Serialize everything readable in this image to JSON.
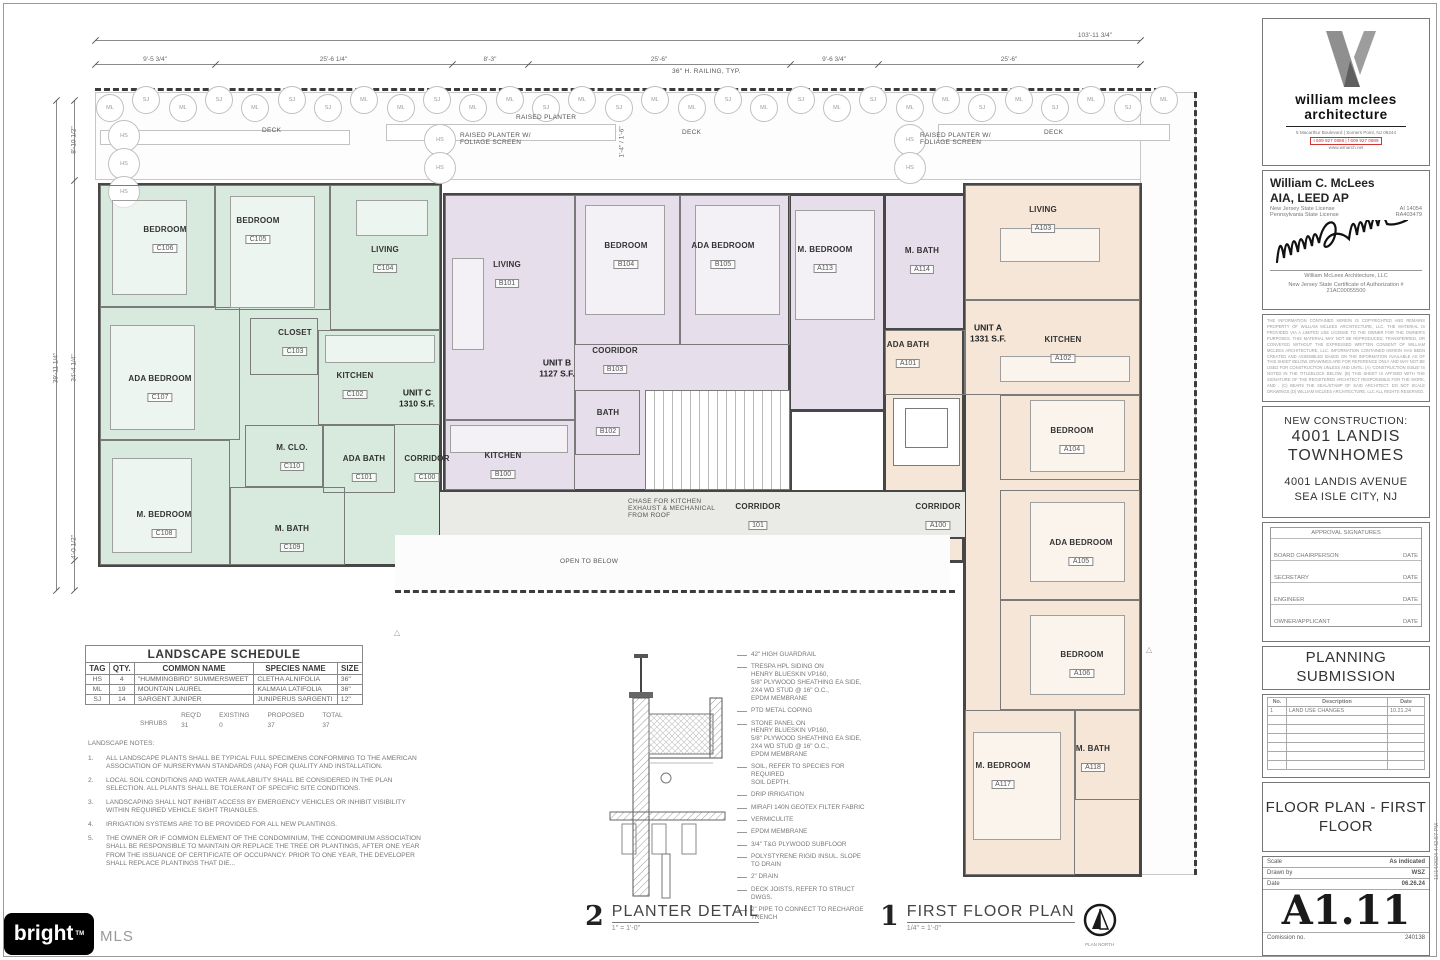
{
  "palette": {
    "unit_c": "#d8e9dd",
    "unit_b": "#e6dfeb",
    "unit_a": "#f5e6d7",
    "wall": "#474747",
    "corridor": "#eaeae7"
  },
  "deck": {
    "deck_label": "DECK",
    "raised_planter": "RAISED PLANTER",
    "raised_planter_screen": "RAISED PLANTER W/ FOLIAGE SCREEN",
    "railing_note": "36\" H. RAILING, TYP.",
    "hs_tag": "HS",
    "tree_tags": [
      "ML",
      "SJ",
      "ML",
      "SJ",
      "ML",
      "SJ",
      "SJ",
      "ML",
      "ML",
      "SJ",
      "ML",
      "ML",
      "SJ",
      "ML",
      "SJ",
      "ML",
      "ML",
      "SJ",
      "ML",
      "SJ",
      "ML",
      "SJ",
      "ML",
      "ML",
      "SJ",
      "ML",
      "SJ",
      "ML",
      "SJ",
      "ML"
    ]
  },
  "dims": {
    "overall": "103'-11 3/4\"",
    "top": [
      "9'-5 3/4\"",
      "25'-6 1/4\"",
      "8'-3\"",
      "25'-6\"",
      "9'-6 3/4\"",
      "25'-6\""
    ],
    "left": [
      "8'-10 1/2\"",
      "39'-11 1/4\"",
      "34'-4 1/4\"",
      "4'-0 1/2\""
    ],
    "planter": "1'-4\" / 1'-6\""
  },
  "plan": {
    "units": [
      {
        "label": "UNIT C",
        "area": "1310 S.F."
      },
      {
        "label": "UNIT B",
        "area": "1127 S.F."
      },
      {
        "label": "UNIT A",
        "area": "1331 S.F."
      }
    ],
    "rooms": [
      {
        "name": "BEDROOM",
        "num": "C106"
      },
      {
        "name": "BEDROOM",
        "num": "C105"
      },
      {
        "name": "LIVING",
        "num": "C104"
      },
      {
        "name": "CLOSET",
        "num": "C103"
      },
      {
        "name": "KITCHEN",
        "num": "C102"
      },
      {
        "name": "ADA BEDROOM",
        "num": "C107"
      },
      {
        "name": "M. CLO.",
        "num": "C110"
      },
      {
        "name": "ADA BATH",
        "num": "C101"
      },
      {
        "name": "CORRIDOR",
        "num": "C100"
      },
      {
        "name": "M. BEDROOM",
        "num": "C108"
      },
      {
        "name": "M. BATH",
        "num": "C109"
      },
      {
        "name": "LIVING",
        "num": "B101"
      },
      {
        "name": "BEDROOM",
        "num": "B104"
      },
      {
        "name": "ADA BEDROOM",
        "num": "B105"
      },
      {
        "name": "COORIDOR",
        "num": "B103"
      },
      {
        "name": "BATH",
        "num": "B102"
      },
      {
        "name": "KITCHEN",
        "num": "B100"
      },
      {
        "name": "M. BEDROOM",
        "num": "A113"
      },
      {
        "name": "M. BATH",
        "num": "A114"
      },
      {
        "name": "ADA BATH",
        "num": "A101"
      },
      {
        "name": "LIVING",
        "num": "A103"
      },
      {
        "name": "KITCHEN",
        "num": "A102"
      },
      {
        "name": "BEDROOM",
        "num": "A104"
      },
      {
        "name": "CORRIDOR",
        "num": "A100"
      },
      {
        "name": "ADA BEDROOM",
        "num": "A105"
      },
      {
        "name": "BEDROOM",
        "num": "A106"
      },
      {
        "name": "M. BEDROOM",
        "num": "A117"
      },
      {
        "name": "M. BATH",
        "num": "A118"
      },
      {
        "name": "CORRIDOR",
        "num": "101"
      }
    ],
    "open_below": "OPEN TO BELOW",
    "chase_note": "CHASE FOR KITCHEN\nEXHAUST & MECHANICAL\nFROM ROOF"
  },
  "landscape_schedule": {
    "title": "LANDSCAPE SCHEDULE",
    "headers": [
      "TAG",
      "QTY.",
      "COMMON NAME",
      "SPECIES NAME",
      "SIZE"
    ],
    "rows": [
      [
        "HS",
        "4",
        "\"HUMMINGBIRD\" SUMMERSWEET",
        "CLETHA ALNIFOLIA",
        "36\""
      ],
      [
        "ML",
        "19",
        "MOUNTAIN LAUREL",
        "KALMAIA LATIFOLIA",
        "36\""
      ],
      [
        "SJ",
        "14",
        "SARGENT JUNIPER",
        "JUNIPERUS SARGENTI",
        "12\""
      ]
    ],
    "summary_label": "SHRUBS",
    "summary": [
      [
        "REQ'D",
        "31"
      ],
      [
        "EXISTING",
        "0"
      ],
      [
        "PROPOSED",
        "37"
      ],
      [
        "TOTAL",
        "37"
      ]
    ]
  },
  "landscape_notes": {
    "title": "LANDSCAPE NOTES:",
    "items": [
      "ALL LANDSCAPE PLANTS SHALL BE TYPICAL FULL SPECIMENS CONFORMING TO THE AMERICAN ASSOCIATION OF NURSERYMAN STANDARDS (ANA) FOR QUALITY AND INSTALLATION.",
      "LOCAL SOIL CONDITIONS AND WATER AVAILABILITY SHALL BE CONSIDERED IN THE PLAN SELECTION. ALL PLANTS SHALL BE TOLERANT OF SPECIFIC SITE CONDITIONS.",
      "LANDSCAPING SHALL NOT INHIBIT ACCESS BY EMERGENCY VEHICLES OR INHIBIT VISIBILITY WITHIN REQUIRED VEHICLE SIGHT TRIANGLES.",
      "IRRIGATION SYSTEMS ARE TO BE PROVIDED FOR ALL NEW PLANTINGS.",
      "THE OWNER OR IF COMMON ELEMENT OF THE CONDOMINIUM, THE CONDOMINIUM ASSOCIATION SHALL BE RESPONSIBLE TO MAINTAIN OR REPLACE THE TREE OR PLANTINGS, AFTER ONE YEAR FROM THE ISSUANCE OF CERTIFICATE OF OCCUPANCY. PRIOR TO ONE YEAR, THE DEVELOPER SHALL REPLACE PLANTINGS THAT DIE..."
    ]
  },
  "planter_detail": {
    "number": "2",
    "title": "PLANTER DETAIL",
    "scale": "1\" = 1'-0\"",
    "callouts": [
      "42\" HIGH GUARDRAIL",
      "TRESPA HPL SIDING ON\nHENRY BLUESKIN VP160,\n5/8\" PLYWOOD SHEATHING EA SIDE,\n2X4 WD STUD @ 16\" O.C.,\nEPDM MEMBRANE",
      "PTD METAL COPING",
      "STONE PANEL ON\nHENRY BLUESKIN VP160,\n5/8\" PLYWOOD SHEATHING EA SIDE,\n2X4 WD STUD @ 16\" O.C.,\nEPDM MEMBRANE",
      "SOIL, REFER TO SPECIES FOR REQUIRED\nSOIL DEPTH.",
      "DRIP IRRIGATION",
      "MIRAFI 140N GEOTEX FILTER FABRIC",
      "VERMICULITE",
      "EPDM MEMBRANE",
      "3/4\" T&G PLYWOOD SUBFLOOR",
      "POLYSTYRENE RIGID INSUL. SLOPE\nTO DRAIN",
      "2\" DRAIN",
      "DECK JOISTS, REFER TO STRUCT DWGS.",
      "2\" PIPE TO CONNECT TO RECHARGE TRENCH"
    ]
  },
  "floor_plan": {
    "number": "1",
    "title": "FIRST FLOOR PLAN",
    "scale": "1/4\" = 1'-0\"",
    "north": "PLAN NORTH"
  },
  "titleblock": {
    "logo": {
      "firm_line1": "william mclees",
      "firm_line2": "architecture",
      "address": "5 Macarthur Boulevard | Somers Point, NJ 08244",
      "phone": "t 609 927 0888 | f 609 927 0889",
      "web": "www.wmarch.net"
    },
    "architect": {
      "name": "William C. McLees",
      "credentials": "AIA, LEED AP",
      "license1_label": "New Jersey State License",
      "license1": "AI 14054",
      "license2_label": "Pennsylvania State License",
      "license2": "RA403479",
      "firm": "William McLees Architecture, LLC",
      "cert": "New Jersey State Certificate of Authorization # 21AC00055500"
    },
    "legal": "THE INFORMATION CONTAINED HEREIN IS COPYRIGHTED AND REMAINS PROPERTY OF WILLIAM MCLEES ARCHITECTURE, LLC. THE MATERIAL IS PROVIDED VIA A LIMITED USE LICENSE TO THE OWNER FOR THE OWNER'S PURPOSES. THIS MATERIAL MAY NOT BE REPRODUCED, TRANSFERRED, OR CONVEYED WITHOUT THE EXPRESSED WRITTEN CONSENT OF WILLIAM MCLEES ARCHITECTURE, LLC. INFORMATION CONTAINED HEREIN HAS BEEN CREATED AND ASSEMBLED BASED ON THE INFORMATION AVAILABLE AS OF THIS SHEET BELOW. DRAWINGS ARE FOR REFERENCE ONLY AND MAY NOT BE USED FOR CONSTRUCTION UNLESS AND UNTIL: (A) 'CONSTRUCTION ISSUE' IS NOTED IN THE TITLEBLOCK BELOW, (B) THIS SHEET IS AFFIXED WITH THE SIGNATURE OF THE REGISTERED ARCHITECT RESPONSIBLE FOR THE WORK, AND , (C) BEARS THE SEAL/STAMP OF SAID ARCHITECT. DO NOT SCALE DRAWINGS.(D) WILLIAM MCLEES ARCHITECTURE, LLC ALL RIGHTS RESERVED.",
    "project": {
      "kind": "NEW CONSTRUCTION:",
      "name1": "4001 LANDIS",
      "name2": "TOWNHOMES",
      "addr1": "4001 LANDIS AVENUE",
      "addr2": "SEA ISLE CITY, NJ"
    },
    "approvals": {
      "title": "APPROVAL SIGNATURES",
      "date_label": "DATE",
      "rows": [
        "BOARD CHAIRPERSON",
        "SECRETARY",
        "ENGINEER",
        "OWNER/APPLICANT"
      ]
    },
    "submission": "PLANNING SUBMISSION",
    "revisions": {
      "headers": [
        "No.",
        "Description",
        "Date"
      ],
      "rows": [
        [
          "1",
          "LAND USE CHANGES",
          "10.21.24"
        ]
      ]
    },
    "sheet_title": "FLOOR PLAN - FIRST FLOOR",
    "info": {
      "scale_label": "Scale",
      "scale": "As indicated",
      "drawn_label": "Drawn by",
      "drawn": "WSZ",
      "date_label": "Date",
      "date": "06.26.24",
      "sheet_no": "A1.11",
      "commission_label": "Comission no.",
      "commission": "240138"
    },
    "timestamp": "11/14/2024 4:42:57 PM"
  },
  "brand": {
    "name": "bright",
    "tm": "TM",
    "suffix": "MLS"
  }
}
